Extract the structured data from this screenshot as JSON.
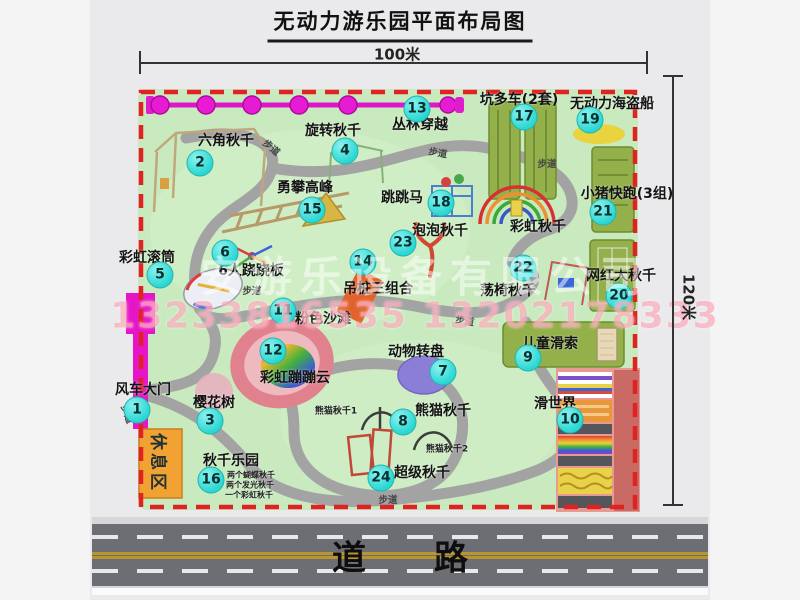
{
  "title": "无动力游乐园平面布局图",
  "dimensions": {
    "width_label": "100米",
    "height_label": "120米"
  },
  "watermark": {
    "company": "安游乐设备有限公司",
    "phone": "13233816535 13202178333"
  },
  "road": {
    "label": "道　　路"
  },
  "map": {
    "rest_area_label": "休息区",
    "accent_colors": {
      "badge": "#2bd7d3",
      "border_dash": "#e02222",
      "park_green": "#c9eabf",
      "gate_magenta": "#e616c8"
    },
    "attractions": [
      {
        "num": 1,
        "label": "风车大门",
        "lx": 143,
        "ly": 389,
        "bx": 137,
        "by": 410
      },
      {
        "num": 2,
        "label": "六角秋千",
        "lx": 226,
        "ly": 140,
        "bx": 200,
        "by": 163
      },
      {
        "num": 3,
        "label": "樱花树",
        "lx": 214,
        "ly": 402,
        "bx": 210,
        "by": 421
      },
      {
        "num": 4,
        "label": "旋转秋千",
        "lx": 333,
        "ly": 130,
        "bx": 345,
        "by": 151
      },
      {
        "num": 5,
        "label": "彩虹滚筒",
        "lx": 147,
        "ly": 257,
        "bx": 160,
        "by": 275
      },
      {
        "num": 6,
        "label": "6人跷跷板",
        "lx": 251,
        "ly": 270,
        "bx": 225,
        "by": 253
      },
      {
        "num": 7,
        "label": "动物转盘",
        "lx": 416,
        "ly": 351,
        "bx": 443,
        "by": 372
      },
      {
        "num": 8,
        "label": "熊猫秋千",
        "lx": 443,
        "ly": 410,
        "bx": 403,
        "by": 422
      },
      {
        "num": 9,
        "label": "儿童滑索",
        "lx": 550,
        "ly": 343,
        "bx": 528,
        "by": 358
      },
      {
        "num": 10,
        "label": "滑世界",
        "lx": 555,
        "ly": 403,
        "bx": 570,
        "by": 420
      },
      {
        "num": 11,
        "label": "粉色沙滩",
        "lx": 323,
        "ly": 318,
        "bx": 283,
        "by": 311
      },
      {
        "num": 12,
        "label": "彩虹蹦蹦云",
        "lx": 295,
        "ly": 377,
        "bx": 273,
        "by": 351
      },
      {
        "num": 13,
        "label": "丛林穿越",
        "lx": 420,
        "ly": 124,
        "bx": 417,
        "by": 109
      },
      {
        "num": 14,
        "label": "吊桩三组合",
        "lx": 378,
        "ly": 288,
        "bx": 363,
        "by": 262
      },
      {
        "num": 15,
        "label": "勇攀高峰",
        "lx": 305,
        "ly": 187,
        "bx": 312,
        "by": 210
      },
      {
        "num": 16,
        "label": "秋千乐园",
        "lx": 231,
        "ly": 460,
        "bx": 211,
        "by": 480
      },
      {
        "num": 17,
        "label": "坑多车(2套)",
        "lx": 519,
        "ly": 99,
        "bx": 524,
        "by": 117
      },
      {
        "num": 18,
        "label": "跳跳马",
        "lx": 402,
        "ly": 197,
        "bx": 441,
        "by": 203
      },
      {
        "num": 19,
        "label": "无动力海盗船",
        "lx": 612,
        "ly": 103,
        "bx": 590,
        "by": 120
      },
      {
        "num": 20,
        "label": "网红大秋千",
        "lx": 621,
        "ly": 275,
        "bx": 619,
        "by": 296
      },
      {
        "num": 21,
        "label": "小猪快跑(3组)",
        "lx": 627,
        "ly": 193,
        "bx": 603,
        "by": 212
      },
      {
        "num": 22,
        "label": "荡椅秋千",
        "lx": 508,
        "ly": 290,
        "bx": 523,
        "by": 268
      },
      {
        "num": 23,
        "label": "泡泡秋千",
        "lx": 440,
        "ly": 230,
        "bx": 403,
        "by": 243
      },
      {
        "num": 24,
        "label": "超级秋千",
        "lx": 422,
        "ly": 472,
        "bx": 381,
        "by": 478
      }
    ],
    "extra_labels": [
      {
        "text": "彩虹秋千",
        "x": 538,
        "y": 226,
        "fs": 14
      }
    ],
    "notes": [
      {
        "text": "熊猫秋千1",
        "x": 336,
        "y": 410,
        "fs": 9
      },
      {
        "text": "熊猫秋千2",
        "x": 447,
        "y": 448,
        "fs": 9
      },
      {
        "text": "两个蝴蝶秋千",
        "x": 251,
        "y": 475,
        "fs": 8
      },
      {
        "text": "两个发光秋千",
        "x": 250,
        "y": 485,
        "fs": 8
      },
      {
        "text": "一个彩虹秋千",
        "x": 249,
        "y": 495,
        "fs": 8
      }
    ],
    "path_labels": [
      {
        "text": "步道",
        "x": 272,
        "y": 147,
        "rot": 40
      },
      {
        "text": "步道",
        "x": 438,
        "y": 152,
        "rot": 10
      },
      {
        "text": "步道",
        "x": 547,
        "y": 163,
        "rot": 0
      },
      {
        "text": "步道",
        "x": 252,
        "y": 290,
        "rot": 0
      },
      {
        "text": "步道",
        "x": 465,
        "y": 320,
        "rot": 10
      },
      {
        "text": "步道",
        "x": 128,
        "y": 414,
        "rot": 70
      },
      {
        "text": "步道",
        "x": 388,
        "y": 499,
        "rot": 0
      }
    ]
  }
}
